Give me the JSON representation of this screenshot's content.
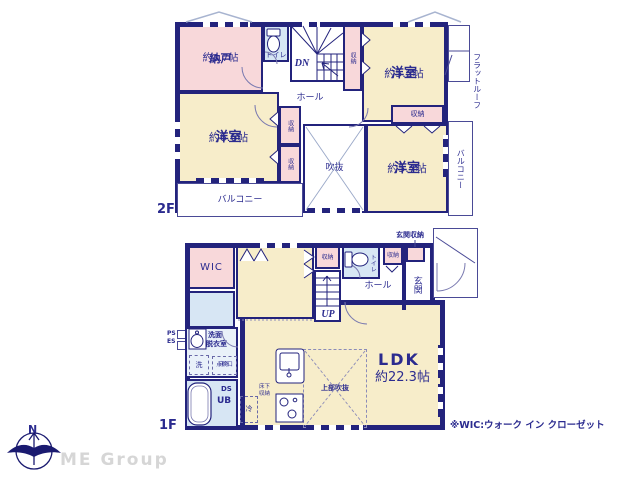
{
  "colors": {
    "wall": "#23237c",
    "cream": "#f7edca",
    "pink": "#f8d8da",
    "blue": "#d7e6f4",
    "text": "#2b2b8f",
    "roofline": "#a8b4d0",
    "logo_gray": "#d6d6d6"
  },
  "f2": {
    "label": "2F",
    "nando": "納戸",
    "nando_size": "約3.7帖",
    "toilet": "トイレ",
    "dn": "DN",
    "closet_a": "収納",
    "yo52": "洋室",
    "yo52_size": "約5.2帖",
    "flat_roof": "フラットルーフ",
    "hall": "ホール",
    "yo66": "洋室",
    "yo66_size": "約6.6帖",
    "closet_b": "収納",
    "closet_c": "収納",
    "fukinuke": "吹抜",
    "closet_d": "収納",
    "yo57": "洋室",
    "yo57_size": "約5.7帖",
    "balcony_right": "バルコニー",
    "balcony_bottom": "バルコニー"
  },
  "f1": {
    "label": "1F",
    "genkan_storage": "玄関収納",
    "wic": "WIC",
    "closet_a": "収納",
    "toilet": "トイレ",
    "closet_b": "収納",
    "genkan": "玄関",
    "hall": "ホール",
    "up": "UP",
    "ps": "PS",
    "es": "ES",
    "senmen1": "洗面",
    "senmen2": "脱衣室",
    "washer": "洗",
    "tenken1": "床下",
    "tenken2": "点検口",
    "ds": "DS",
    "ub": "UB",
    "fridge": "冷",
    "shuno1": "床下",
    "shuno2": "収納",
    "jobu_fukinuke": "上部吹抜",
    "ldk": "LDK",
    "ldk_size": "約22.3帖"
  },
  "footer": {
    "north": "N",
    "logo": "ME Group",
    "note": "※WIC:ウォーク イン クローゼット"
  }
}
